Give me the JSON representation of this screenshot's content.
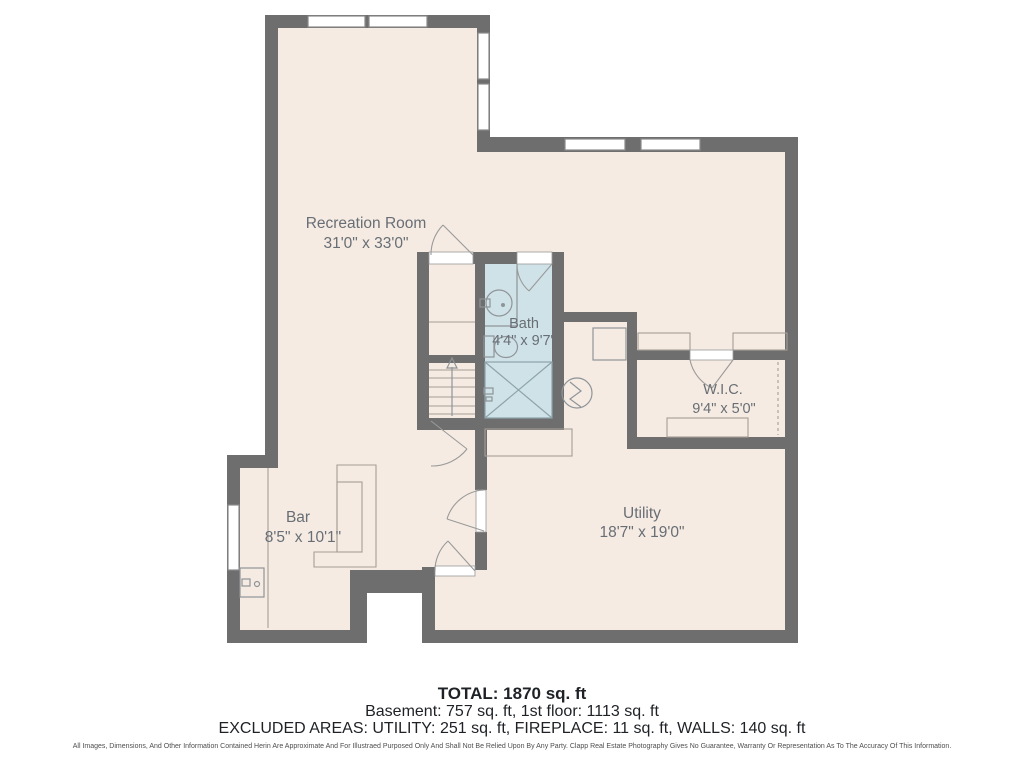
{
  "palette": {
    "background": "#ffffff",
    "floor": "#f5ebe2",
    "wall": "#6e6e6e",
    "bath_floor": "#cfe2e7",
    "furniture_line": "#a59d96",
    "fixture_line": "#8f9499",
    "label_text": "#686e75",
    "summary_text": "#1e2125"
  },
  "rooms": [
    {
      "name": "Recreation Room",
      "dims": "31'0\" x 33'0\""
    },
    {
      "name": "Bath",
      "dims": "4'4\" x 9'7\""
    },
    {
      "name": "W.I.C.",
      "dims": "9'4\" x 5'0\""
    },
    {
      "name": "Bar",
      "dims": "8'5\" x 10'1\""
    },
    {
      "name": "Utility",
      "dims": "18'7\" x 19'0\""
    }
  ],
  "summary": {
    "total": "TOTAL: 1870 sq. ft",
    "breakdown": "Basement: 757 sq. ft, 1st floor: 1113 sq. ft",
    "excluded": "EXCLUDED AREAS: UTILITY: 251 sq. ft, FIREPLACE: 11 sq. ft, WALLS: 140 sq. ft",
    "disclaimer": "All Images, Dimensions, And Other Information Contained Herin Are Approximate And For Illustraed Purposed Only And Shall Not Be Relied Upon By Any Party. Clapp Real Estate Photography Gives No Guarantee, Warranty Or Representation As To The Accuracy Of This Information."
  }
}
